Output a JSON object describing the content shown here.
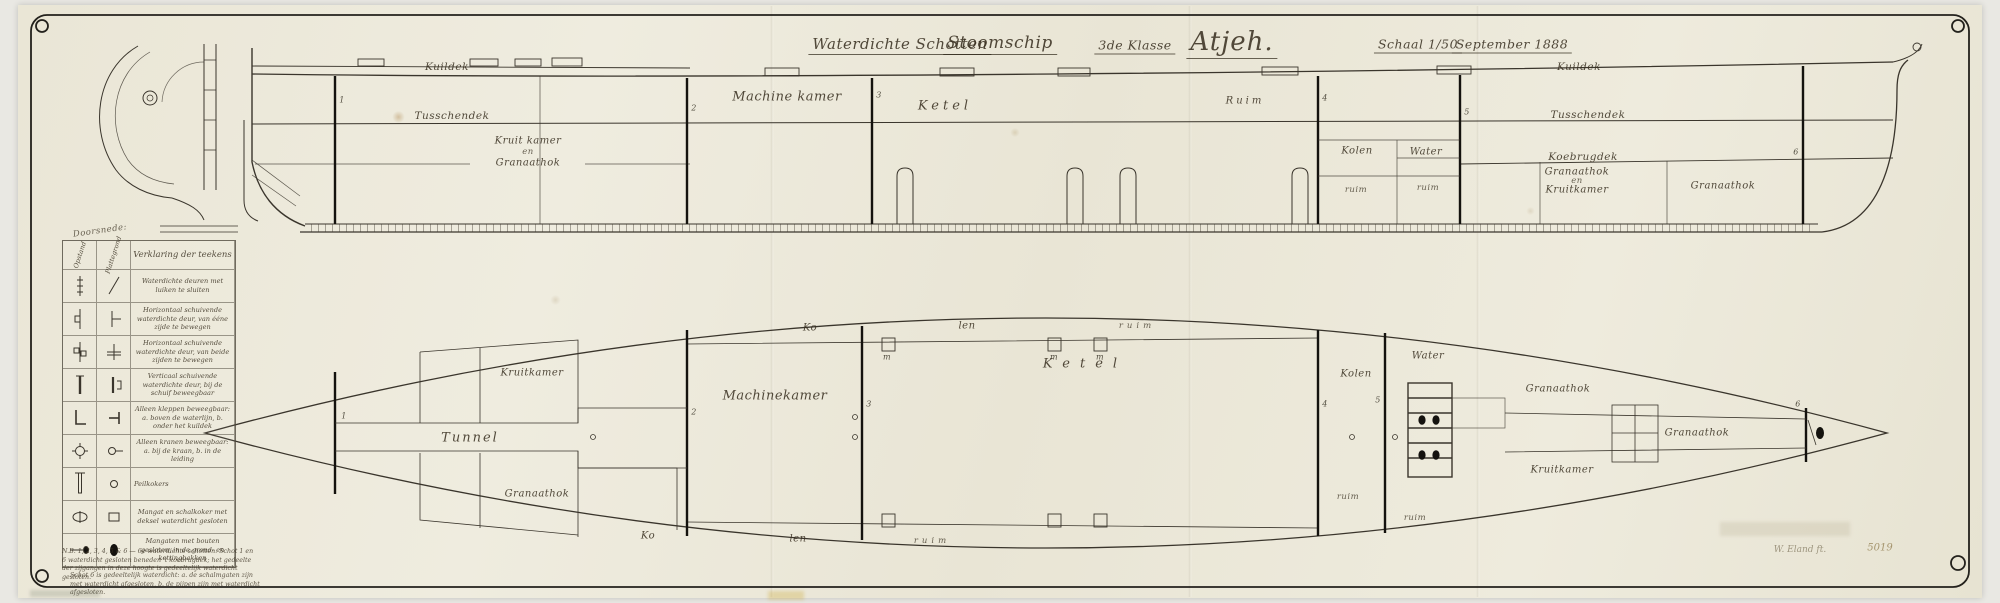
{
  "doc": {
    "title": {
      "part1": "Waterdichte Schotten",
      "part2": "Stoomschip",
      "klasse": "3de Klasse",
      "ship_name": "Atjeh.",
      "schaal": "Schaal 1/50",
      "date": "September 1888"
    },
    "signature": {
      "name": "W. Eland ft.",
      "number": "5019"
    }
  },
  "profile": {
    "kuildek": "Kuildek",
    "tusschendek": "Tusschendek",
    "koebrugdek": "Koebrugdek",
    "machinekamer": "Machine kamer",
    "ketel": "Ketel",
    "ruim": "Ruim",
    "ruim_small": "ruim",
    "kolen": "Kolen",
    "water": "Water",
    "kkg": [
      "Kruit kamer",
      "en",
      "Granaathok"
    ],
    "gek": [
      "Granaathok",
      "en",
      "Kruitkamer"
    ],
    "granaathok": "Granaathok"
  },
  "plan": {
    "kruitkamer": "Kruitkamer",
    "tunnel": "Tunnel",
    "granaathok": "Granaathok",
    "machinekamer": "Machinekamer",
    "ketel": "Ketel",
    "ko": "Ko",
    "len": "len",
    "ruim": "ruim",
    "kolen": "Kolen",
    "water": "Water"
  },
  "marks": {
    "n1": "1",
    "n2": "2",
    "n3": "3",
    "n4": "4",
    "n5": "5",
    "n6": "6",
    "m": "m"
  },
  "legend": {
    "note": "Doorsnede:",
    "col_section": "Opstand",
    "col_plan": "Plattegrond",
    "title": "Verklaring der teekens",
    "rows": [
      {
        "text": "Waterdichte deuren met luiken te sluiten"
      },
      {
        "text": "Horizontaal schuivende waterdichte deur, van ééne zijde te bewegen"
      },
      {
        "text": "Horizontaal schuivende waterdichte deur, van beide zijden te bewegen"
      },
      {
        "text": "Verticaal schuivende waterdichte deur, bij de schuif beweegbaar"
      },
      {
        "text": "Alleen kleppen beweegbaar: a. boven de waterlijn, b. onder het kuildek"
      },
      {
        "text": "Alleen kranen beweegbaar: a. bij de kraan, b. in de leiding"
      },
      {
        "text": "Peilkokers"
      },
      {
        "text": "Mangat en schalkoker met deksel waterdicht gesloten"
      },
      {
        "text": "Mangaten met bouten gesloten, in de grond- en kettingbakken"
      }
    ],
    "footnotes": [
      "N.B. 1, 2, 3, 4, 5 & 6 — 6e waterdichte schotten. Schot 1 en 6 waterdicht gesloten beneden 't koebrugdek; het gedeelte der zijgangen in deze hoogte is gedeeltelijk waterdicht gesloten.",
      "Schot 6 is gedeeltelijk waterdicht: a. de schalmgaten zijn met waterdicht afgesloten, b. de pijpen zijn met waterdicht afgesloten."
    ]
  }
}
